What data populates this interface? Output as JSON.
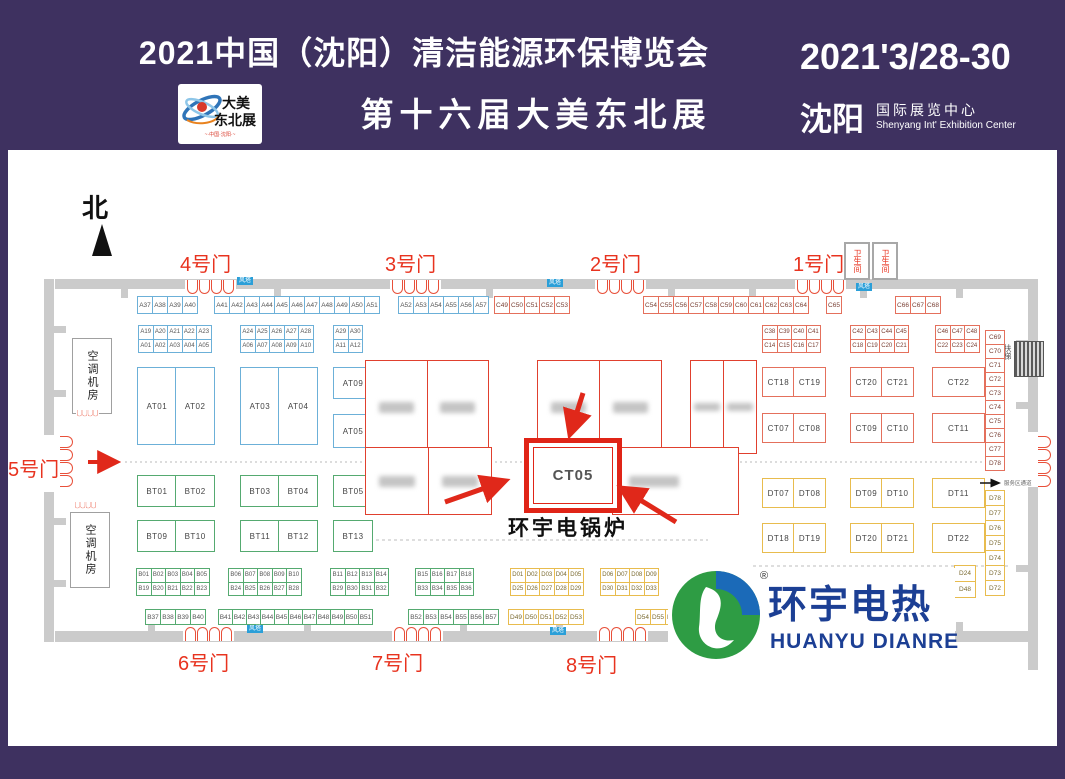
{
  "banner": {
    "title_line1": "2021中国（沈阳）清洁能源环保博览会",
    "title_line2": "第十六届大美东北展",
    "logo_card": {
      "line1": "大美",
      "line2": "东北展",
      "subtitle": "~·中国·沈阳·~"
    },
    "date": "2021'3/28-30",
    "city": "沈阳",
    "venue_cn": "国际展览中心",
    "venue_en": "Shenyang Int' Exhibition Center"
  },
  "map": {
    "north": "北",
    "gates": {
      "g1": "1号门",
      "g2": "2号门",
      "g3": "3号门",
      "g4": "4号门",
      "g5": "5号门",
      "g6": "6号门",
      "g7": "7号门",
      "g8": "8号门"
    },
    "restroom": "卫生间",
    "wind_tower": "风塔",
    "ac_room": "空调机房",
    "escalator": "扶梯",
    "service_corridor": "服务区通道",
    "highlight": {
      "booth": "CT05",
      "caption": "环宇电锅炉"
    }
  },
  "booths": {
    "top_a37": [
      "A37",
      "A38",
      "A39",
      "A40"
    ],
    "top_a41": [
      "A41",
      "A42",
      "A43",
      "A44",
      "A45",
      "A46",
      "A47",
      "A48",
      "A49",
      "A50",
      "A51"
    ],
    "top_a52": [
      "A52",
      "A53",
      "A54",
      "A55",
      "A56",
      "A57"
    ],
    "top_c49": [
      "C49",
      "C50",
      "C51",
      "C52",
      "C53"
    ],
    "top_c54": [
      "C54",
      "C55",
      "C56",
      "C57",
      "C58",
      "C59",
      "C60",
      "C61",
      "C62",
      "C63",
      "C64"
    ],
    "top_c65": [
      "C65"
    ],
    "top_c66": [
      "C66",
      "C67",
      "C68"
    ],
    "grid_a19": [
      [
        "A19",
        "A20",
        "A21",
        "A22",
        "A23"
      ],
      [
        "A01",
        "A02",
        "A03",
        "A04",
        "A05"
      ]
    ],
    "grid_a24": [
      [
        "A24",
        "A25",
        "A26",
        "A27",
        "A28"
      ],
      [
        "A06",
        "A07",
        "A08",
        "A09",
        "A10"
      ]
    ],
    "grid_a29": [
      [
        "A29",
        "A30"
      ],
      [
        "A11",
        "A12"
      ]
    ],
    "grid_c38": [
      [
        "C38",
        "C39",
        "C40",
        "C41"
      ],
      [
        "C14",
        "C15",
        "C16",
        "C17"
      ]
    ],
    "grid_c42": [
      [
        "C42",
        "C43",
        "C44",
        "C45"
      ],
      [
        "C18",
        "C19",
        "C20",
        "C21"
      ]
    ],
    "grid_c46": [
      [
        "C46",
        "C47",
        "C48"
      ],
      [
        "C22",
        "C23",
        "C24"
      ]
    ],
    "at_left": [
      "AT01",
      "AT02"
    ],
    "at_mid": [
      "AT03",
      "AT04"
    ],
    "at_09": [
      "AT09"
    ],
    "at_05": [
      "AT05"
    ],
    "bt_r1a": [
      "BT01",
      "BT02"
    ],
    "bt_r1b": [
      "BT03",
      "BT04"
    ],
    "bt_r1c": [
      "BT05"
    ],
    "bt_r2a": [
      "BT09",
      "BT10"
    ],
    "bt_r2b": [
      "BT11",
      "BT12"
    ],
    "bt_r2c": [
      "BT13"
    ],
    "ct_r1a": [
      "CT18",
      "CT19"
    ],
    "ct_r1b": [
      "CT20",
      "CT21"
    ],
    "ct_r1c": [
      "CT22"
    ],
    "ct_r2a": [
      "CT07",
      "CT08"
    ],
    "ct_r2b": [
      "CT09",
      "CT10"
    ],
    "ct_r2c": [
      "CT11"
    ],
    "dt_r1a": [
      "DT07",
      "DT08"
    ],
    "dt_r1b": [
      "DT09",
      "DT10"
    ],
    "dt_r1c": [
      "DT11"
    ],
    "dt_r2a": [
      "DT18",
      "DT19"
    ],
    "dt_r2b": [
      "DT20",
      "DT21"
    ],
    "dt_r2c": [
      "DT22"
    ],
    "grid_b01": [
      [
        "B01",
        "B02",
        "B03",
        "B04",
        "B05"
      ],
      [
        "B19",
        "B20",
        "B21",
        "B22",
        "B23"
      ]
    ],
    "grid_b06": [
      [
        "B06",
        "B07",
        "B08",
        "B09",
        "B10"
      ],
      [
        "B24",
        "B25",
        "B26",
        "B27",
        "B28"
      ]
    ],
    "grid_b11": [
      [
        "B11",
        "B12",
        "B13",
        "B14"
      ],
      [
        "B29",
        "B30",
        "B31",
        "B32"
      ]
    ],
    "grid_b15": [
      [
        "B15",
        "B16",
        "B17",
        "B18"
      ],
      [
        "B33",
        "B34",
        "B35",
        "B36"
      ]
    ],
    "grid_d01": [
      [
        "D01",
        "D02",
        "D03",
        "D04",
        "D05"
      ],
      [
        "D25",
        "D26",
        "D27",
        "D28",
        "D29"
      ]
    ],
    "grid_d06": [
      [
        "D06",
        "D07",
        "D08",
        "D09"
      ],
      [
        "D30",
        "D31",
        "D32",
        "D33"
      ]
    ],
    "row_b37": [
      "B37",
      "B38",
      "B39",
      "B40"
    ],
    "row_b41": [
      "B41",
      "B42",
      "B43",
      "B44",
      "B45",
      "B46",
      "B47",
      "B48",
      "B49",
      "B50",
      "B51"
    ],
    "row_b52": [
      "B52",
      "B53",
      "B54",
      "B55",
      "B56",
      "B57"
    ],
    "row_d49": [
      "D49",
      "D50",
      "D51",
      "D52",
      "D53"
    ],
    "row_d54": [
      "D54",
      "D55",
      "D56"
    ],
    "col_d24": [
      "D24",
      "D48"
    ],
    "col_c69": [
      "C69",
      "C70",
      "C71",
      "C72",
      "C73",
      "C74",
      "C75",
      "C76",
      "C77",
      "D78"
    ],
    "col_d78": [
      "D78",
      "D77",
      "D76",
      "D75",
      "D74",
      "D73",
      "D72"
    ]
  },
  "logo": {
    "reg": "®",
    "cn": "环宇电热",
    "en": "HUANYU DIANRE"
  },
  "colors": {
    "purple": "#3e3160",
    "gate_red": "#e8331f",
    "highlight_red": "#e02417",
    "booth_red": "#e4705c",
    "booth_blue": "#6cb0d8",
    "booth_green": "#55aa70",
    "booth_yellow": "#e8bc4e",
    "wind_tower_bg": "#2b9fd8",
    "logo_blue": "#1c3f94",
    "logo_green": "#2e9c44",
    "wall_gray": "#cbcbcb"
  }
}
